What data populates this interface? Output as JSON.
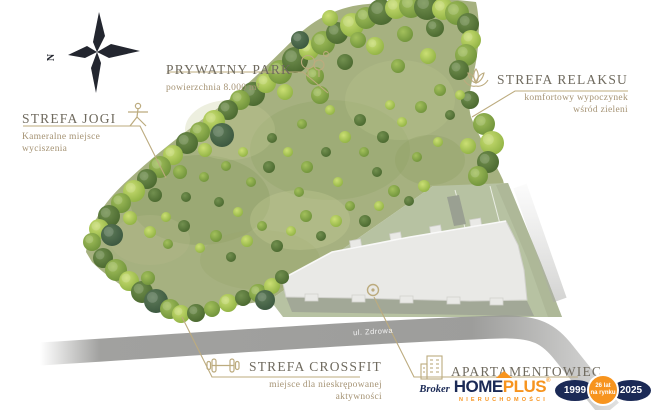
{
  "compass": {
    "letter": "N"
  },
  "labels": {
    "park": {
      "title": "PRYWATNY PARK",
      "subtitle": "powierzchnia 8.000 m²"
    },
    "yoga": {
      "title": "STREFA JOGI",
      "subtitle": "Kameralne miejsce wyciszenia"
    },
    "relax": {
      "title": "STREFA RELAKSU",
      "subtitle": "komfortowy wypoczynek wśród zieleni"
    },
    "crossfit": {
      "title": "STREFA CROSSFIT",
      "subtitle": "miejsce dla nieskrępowanej aktywności"
    },
    "apartment": {
      "title": "APARTAMENTOWIEC"
    }
  },
  "map": {
    "street": "ul. Zdrowa"
  },
  "logo": {
    "prefix": "Broker",
    "brand_home": "HOME",
    "brand_plus": "PLUS",
    "registered": "®",
    "tagline": "NIERUCHOMOŚCI",
    "badge_start": "1999",
    "badge_mid_line1": "26 lat",
    "badge_mid_line2": "na rynku",
    "badge_end": "2025"
  },
  "colors": {
    "accent_tan": "#bcab7e",
    "heading": "#6f6a5e",
    "navy": "#1b2a56",
    "orange": "#f7941e",
    "park_green": "#a6b180"
  }
}
